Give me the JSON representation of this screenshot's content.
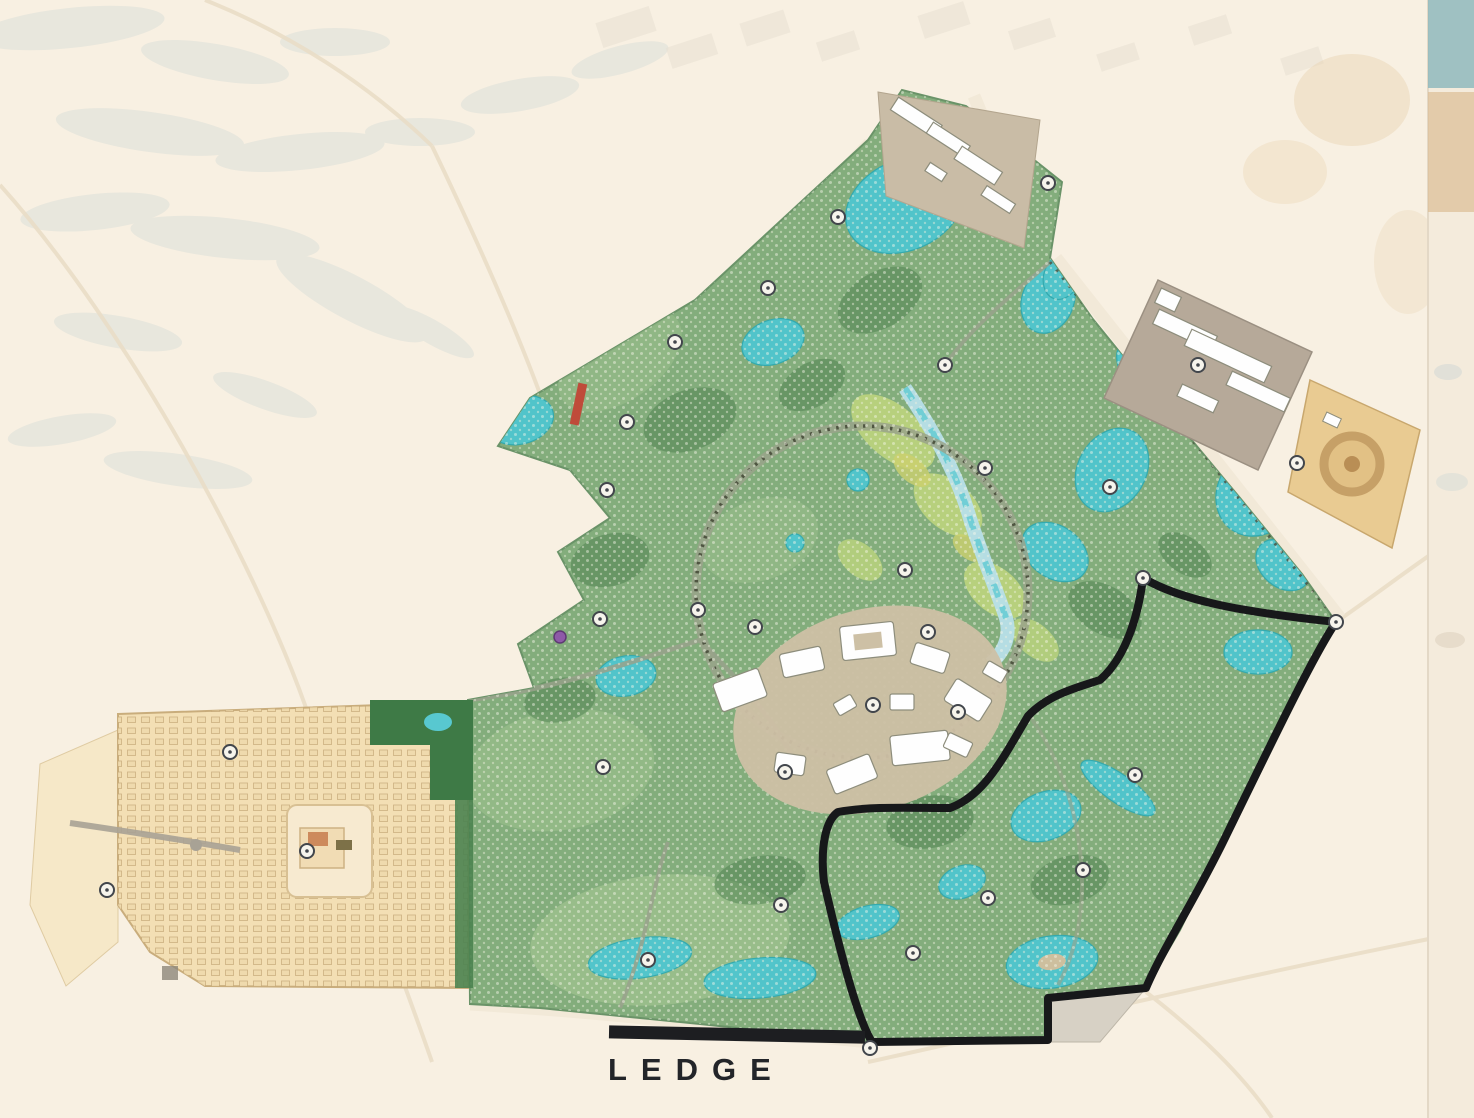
{
  "map": {
    "type": "masterplan",
    "label": {
      "text": "LEDGE"
    },
    "highlighted_parcel": {
      "name": "LEDGE",
      "outline_color": "#17181a"
    },
    "palette": {
      "background": "#f8f0e2",
      "greenery_base": "#83ad7c",
      "greenery_dark": "#4c7f4f",
      "water": "#4fc6cf",
      "district_tan": "#f3dfb4",
      "buildings_white": "#fefefe",
      "outline_black": "#17181a"
    },
    "markers": [
      {
        "x": 1143,
        "y": 578,
        "label": ""
      },
      {
        "x": 1336,
        "y": 622,
        "label": ""
      },
      {
        "x": 870,
        "y": 1048,
        "label": ""
      },
      {
        "x": 675,
        "y": 342,
        "label": ""
      },
      {
        "x": 627,
        "y": 422,
        "label": ""
      },
      {
        "x": 607,
        "y": 490,
        "label": ""
      },
      {
        "x": 600,
        "y": 619,
        "label": ""
      },
      {
        "x": 698,
        "y": 610,
        "label": ""
      },
      {
        "x": 945,
        "y": 365,
        "label": ""
      },
      {
        "x": 985,
        "y": 468,
        "label": ""
      },
      {
        "x": 905,
        "y": 570,
        "label": ""
      },
      {
        "x": 928,
        "y": 632,
        "label": ""
      },
      {
        "x": 755,
        "y": 627,
        "label": ""
      },
      {
        "x": 873,
        "y": 705,
        "label": ""
      },
      {
        "x": 958,
        "y": 712,
        "label": ""
      },
      {
        "x": 785,
        "y": 772,
        "label": ""
      },
      {
        "x": 1048,
        "y": 183,
        "label": ""
      },
      {
        "x": 838,
        "y": 217,
        "label": ""
      },
      {
        "x": 768,
        "y": 288,
        "label": ""
      },
      {
        "x": 1110,
        "y": 487,
        "label": ""
      },
      {
        "x": 1198,
        "y": 365,
        "label": ""
      },
      {
        "x": 1297,
        "y": 463,
        "label": ""
      },
      {
        "x": 1135,
        "y": 775,
        "label": ""
      },
      {
        "x": 1083,
        "y": 870,
        "label": ""
      },
      {
        "x": 988,
        "y": 898,
        "label": ""
      },
      {
        "x": 913,
        "y": 953,
        "label": ""
      },
      {
        "x": 781,
        "y": 905,
        "label": ""
      },
      {
        "x": 230,
        "y": 752,
        "label": ""
      },
      {
        "x": 307,
        "y": 851,
        "label": ""
      },
      {
        "x": 107,
        "y": 890,
        "label": ""
      },
      {
        "x": 603,
        "y": 767,
        "label": ""
      },
      {
        "x": 648,
        "y": 960,
        "label": ""
      }
    ],
    "accent_marks": [
      {
        "type": "red-strip",
        "x": 578,
        "y": 404
      },
      {
        "type": "purple-dot",
        "x": 560,
        "y": 637
      }
    ]
  }
}
